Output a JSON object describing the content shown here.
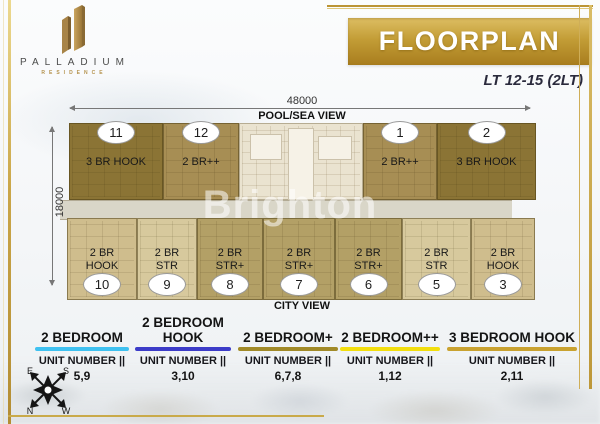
{
  "logo": {
    "name": "PALLADIUM",
    "subtitle": "RESIDENCE"
  },
  "header": {
    "banner_title": "FLOORPLAN",
    "level_label": "LT 12-15 (2LT)"
  },
  "floorplan": {
    "dim_width": "48000",
    "dim_height": "18000",
    "view_top": "POOL/SEA VIEW",
    "view_bottom": "CITY VIEW",
    "watermark": "Brighton",
    "top_units": [
      {
        "number": "11",
        "label": "3 BR HOOK"
      },
      {
        "number": "12",
        "label": "2 BR++"
      },
      {
        "number": "1",
        "label": "2 BR++"
      },
      {
        "number": "2",
        "label": "3 BR HOOK"
      }
    ],
    "bottom_units": [
      {
        "number": "10",
        "label_line1": "2 BR",
        "label_line2": "HOOK"
      },
      {
        "number": "9",
        "label_line1": "2 BR",
        "label_line2": "STR"
      },
      {
        "number": "8",
        "label_line1": "2 BR",
        "label_line2": "STR+"
      },
      {
        "number": "7",
        "label_line1": "2 BR",
        "label_line2": "STR+"
      },
      {
        "number": "6",
        "label_line1": "2 BR",
        "label_line2": "STR+"
      },
      {
        "number": "5",
        "label_line1": "2 BR",
        "label_line2": "STR"
      },
      {
        "number": "3",
        "label_line1": "2 BR",
        "label_line2": "HOOK"
      }
    ]
  },
  "legend": [
    {
      "title": "2 BEDROOM",
      "unit_label": "UNIT NUMBER ||",
      "units": "5,9",
      "color": "#3fc1f0"
    },
    {
      "title": "2 BEDROOM HOOK",
      "unit_label": "UNIT NUMBER ||",
      "units": "3,10",
      "color": "#3c3cc8"
    },
    {
      "title": "2 BEDROOM+",
      "unit_label": "UNIT NUMBER ||",
      "units": "6,7,8",
      "color": "#a18a28"
    },
    {
      "title": "2 BEDROOM++",
      "unit_label": "UNIT NUMBER ||",
      "units": "1,12",
      "color": "#f2de0e"
    },
    {
      "title": "3 BEDROOM HOOK",
      "unit_label": "UNIT NUMBER ||",
      "units": "2,11",
      "color": "#c9a230"
    }
  ],
  "compass": {
    "top_left": "E",
    "top_right": "S",
    "bottom_left": "N",
    "bottom_right": "W"
  },
  "colors": {
    "unit_3br_hook": "#8b7435",
    "unit_2br_pp": "#a78e54",
    "unit_2br_strp": "#b3a066",
    "unit_2br_str": "#d7c99d",
    "unit_2br_hook": "#cfbd8d",
    "core": "#eae3d0",
    "corridor": "#d9d6c8",
    "banner_gold": "#c39d36",
    "frame_gold": "#c9a545"
  }
}
